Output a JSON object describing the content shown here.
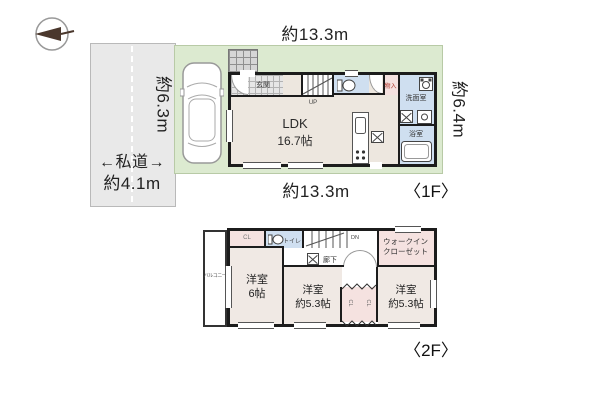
{
  "site": {
    "dim_top": "約13.3m",
    "dim_bottom": "約13.3m",
    "dim_left": "約6.3m",
    "dim_right": "約6.4m",
    "road_name": "←私道→",
    "road_width": "約4.1m",
    "floor1_tag": "〈1F〉",
    "floor2_tag": "〈2F〉"
  },
  "floor1": {
    "genkan": "玄関",
    "up": "UP",
    "ldk_name": "LDK",
    "ldk_size": "16.7帖",
    "monoire": "物入",
    "senmenshitsu": "洗面室",
    "yokushitsu": "浴室"
  },
  "floor2": {
    "balcony": "バルコニー",
    "cl": "CL",
    "toilet": "トイレ",
    "dn": "DN",
    "rouka": "廊下",
    "wic_line1": "ウォークイン",
    "wic_line2": "クローゼット",
    "rooms": [
      {
        "name": "洋室",
        "size": "6帖"
      },
      {
        "name": "洋室",
        "size": "約5.3帖"
      },
      {
        "name": "洋室",
        "size": "約5.3帖"
      }
    ]
  },
  "colors": {
    "site_green": "#dcead0",
    "road_gray": "#e9e9e9",
    "floor_beige": "#ede7df",
    "room_beige_pink": "#f0e9e4",
    "closet_pink": "#f5e2e0",
    "wet_area_blue": "#cfdff0",
    "wall_dark": "#1c1c1c",
    "monoire_red": "#b03a2e"
  }
}
